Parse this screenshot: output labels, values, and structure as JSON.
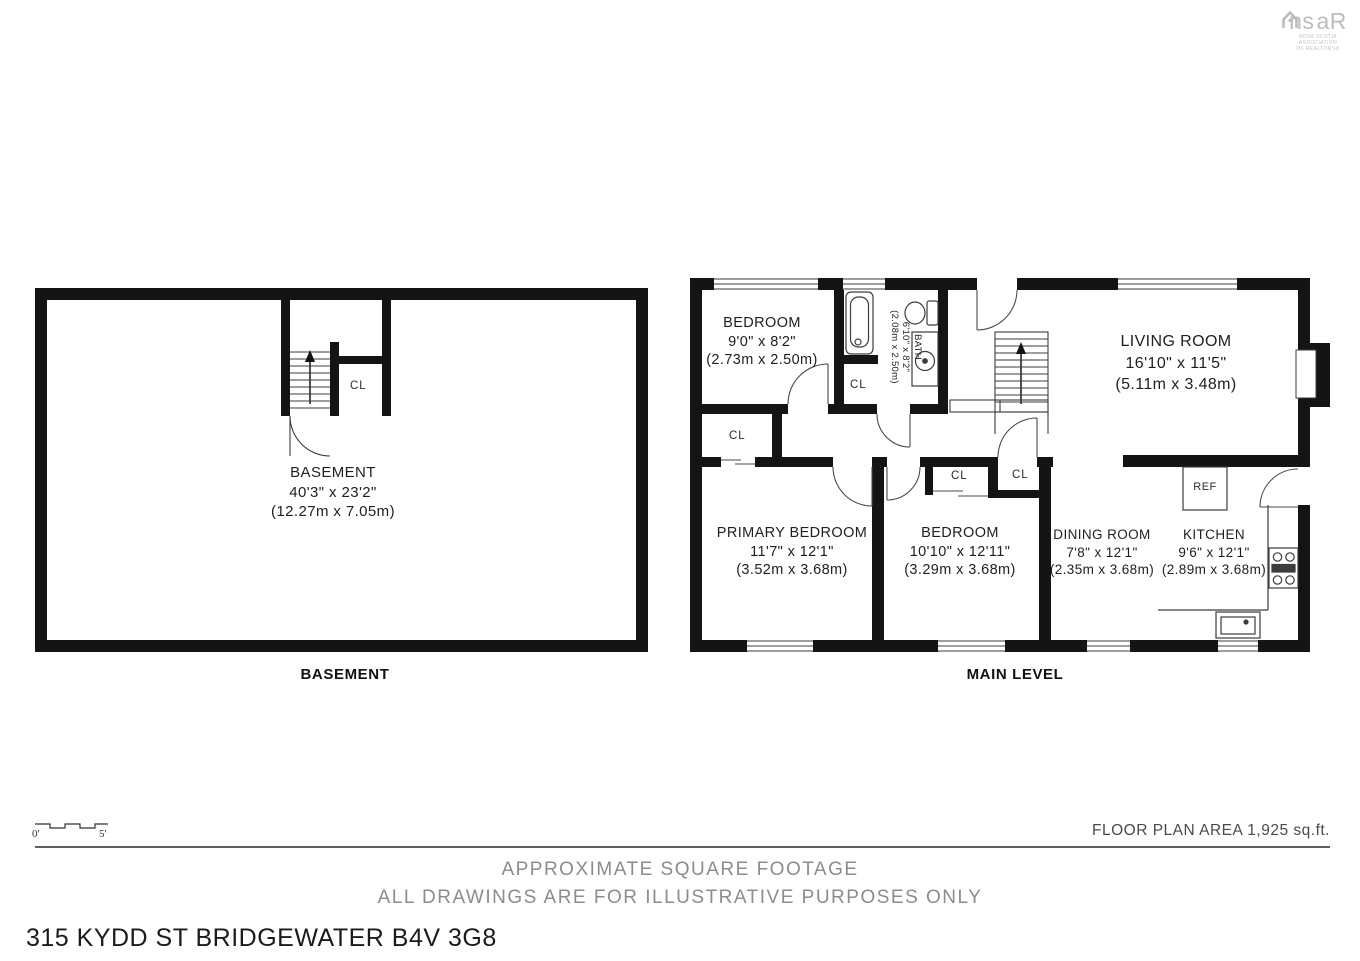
{
  "logo": {
    "brand_left": "ns",
    "brand_right": "aR",
    "subtitle1": "NOVA SCOTIA ASSOCIATION",
    "subtitle2": "OF REALTORS®"
  },
  "plans": {
    "basement": {
      "caption": "BASEMENT",
      "room": {
        "name": "BASEMENT",
        "imperial": "40'3\" x 23'2\"",
        "metric": "(12.27m x 7.05m)"
      }
    },
    "main": {
      "caption": "MAIN LEVEL",
      "rooms": {
        "bedroom_top": {
          "name": "BEDROOM",
          "imperial": "9'0\" x 8'2\"",
          "metric": "(2.73m x 2.50m)"
        },
        "bath": {
          "name": "BATH",
          "imperial": "6'10\" x 8'2\"",
          "metric": "(2.08m x 2.50m)"
        },
        "living": {
          "name": "LIVING ROOM",
          "imperial": "16'10\" x 11'5\"",
          "metric": "(5.11m x 3.48m)"
        },
        "primary": {
          "name": "PRIMARY BEDROOM",
          "imperial": "11'7\" x 12'1\"",
          "metric": "(3.52m x 3.68m)"
        },
        "bedroom2": {
          "name": "BEDROOM",
          "imperial": "10'10\" x 12'11\"",
          "metric": "(3.29m x 3.68m)"
        },
        "dining": {
          "name": "DINING ROOM",
          "imperial": "7'8\" x 12'1\"",
          "metric": "(2.35m x 3.68m)"
        },
        "kitchen": {
          "name": "KITCHEN",
          "imperial": "9'6\" x 12'1\"",
          "metric": "(2.89m x 3.68m)"
        }
      },
      "labels": {
        "closet": "CL",
        "fridge": "REF"
      }
    }
  },
  "scale_bar": {
    "start": "0'",
    "end": "5'"
  },
  "footer": {
    "area": "FLOOR PLAN AREA 1,925 sq.ft.",
    "note1": "APPROXIMATE SQUARE FOOTAGE",
    "note2": "ALL DRAWINGS ARE FOR ILLUSTRATIVE PURPOSES ONLY",
    "address": "315 KYDD ST BRIDGEWATER B4V 3G8"
  },
  "colors": {
    "wall": "#141414",
    "thin_line": "#3d3d3d",
    "note_gray": "#8c8c8c",
    "logo_gray": "#bcbcbc"
  }
}
